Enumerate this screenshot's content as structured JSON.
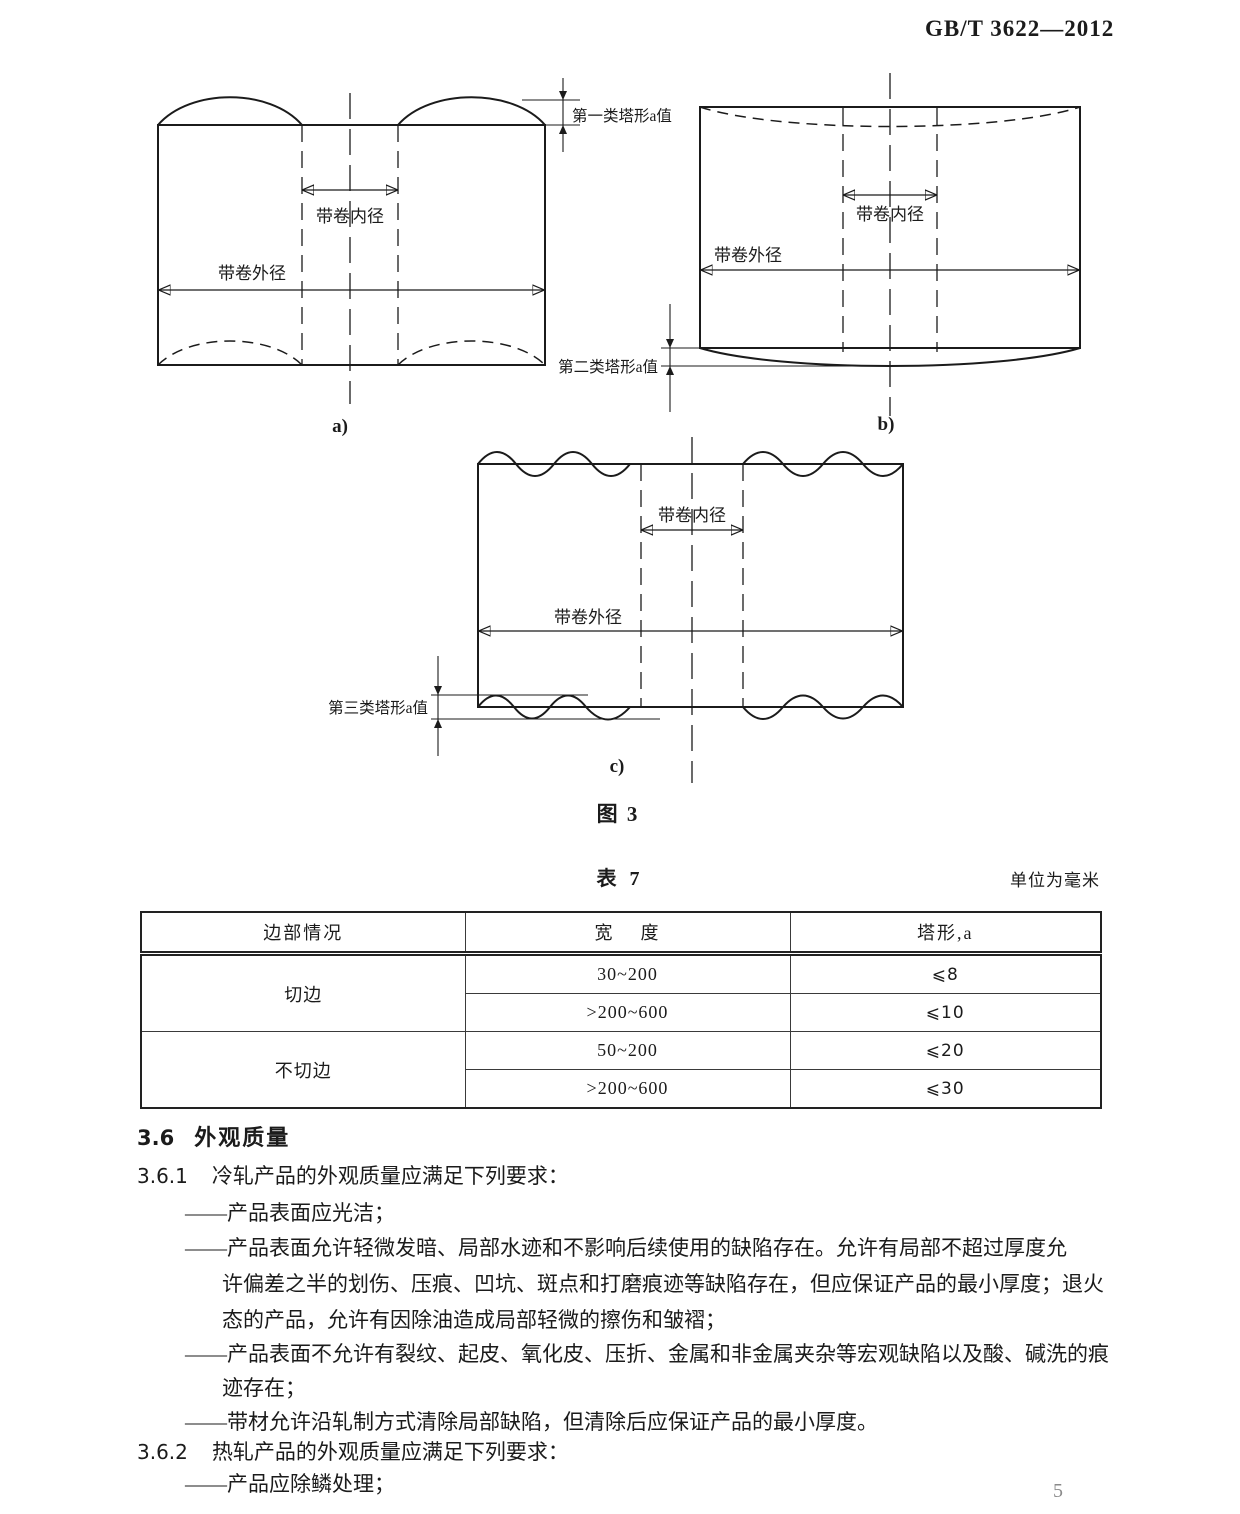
{
  "page": {
    "doc_code": "GB/T 3622—2012",
    "page_number": "5"
  },
  "figure3": {
    "caption": "图 3",
    "labels": {
      "inner_diameter": "带卷内径",
      "outer_diameter": "带卷外径"
    },
    "sub_a": {
      "caption": "a)",
      "tower_label": "第一类塔形a值"
    },
    "sub_b": {
      "caption": "b)",
      "tower_label": "第二类塔形a值"
    },
    "sub_c": {
      "caption": "c)",
      "tower_label": "第三类塔形a值"
    }
  },
  "table7": {
    "title": "表 7",
    "unit_note": "单位为毫米",
    "columns": [
      "边部情况",
      "宽    度",
      "塔形,a"
    ],
    "groups": [
      {
        "edge": "切边",
        "entries": [
          {
            "width": "30~200",
            "tower": "⩽8"
          },
          {
            "width": ">200~600",
            "tower": "⩽10"
          }
        ]
      },
      {
        "edge": "不切边",
        "entries": [
          {
            "width": "50~200",
            "tower": "⩽20"
          },
          {
            "width": ">200~600",
            "tower": "⩽30"
          }
        ]
      }
    ]
  },
  "body": {
    "heading": {
      "number": "3.6",
      "title": "外观质量"
    },
    "clause_361": {
      "number": "3.6.1",
      "text": "冷轧产品的外观质量应满足下列要求："
    },
    "cold_items": [
      {
        "lines": [
          "——产品表面应光洁；"
        ]
      },
      {
        "lines": [
          "——产品表面允许轻微发暗、局部水迹和不影响后续使用的缺陷存在。允许有局部不超过厚度允",
          "许偏差之半的划伤、压痕、凹坑、斑点和打磨痕迹等缺陷存在，但应保证产品的最小厚度；退火",
          "态的产品，允许有因除油造成局部轻微的擦伤和皱褶；"
        ]
      },
      {
        "lines": [
          "——产品表面不允许有裂纹、起皮、氧化皮、压折、金属和非金属夹杂等宏观缺陷以及酸、碱洗的痕",
          "迹存在；"
        ]
      },
      {
        "lines": [
          "——带材允许沿轧制方式清除局部缺陷，但清除后应保证产品的最小厚度。"
        ]
      }
    ],
    "clause_362": {
      "number": "3.6.2",
      "text": "热轧产品的外观质量应满足下列要求："
    },
    "hot_items": [
      {
        "lines": [
          "——产品应除鳞处理；"
        ]
      }
    ]
  }
}
